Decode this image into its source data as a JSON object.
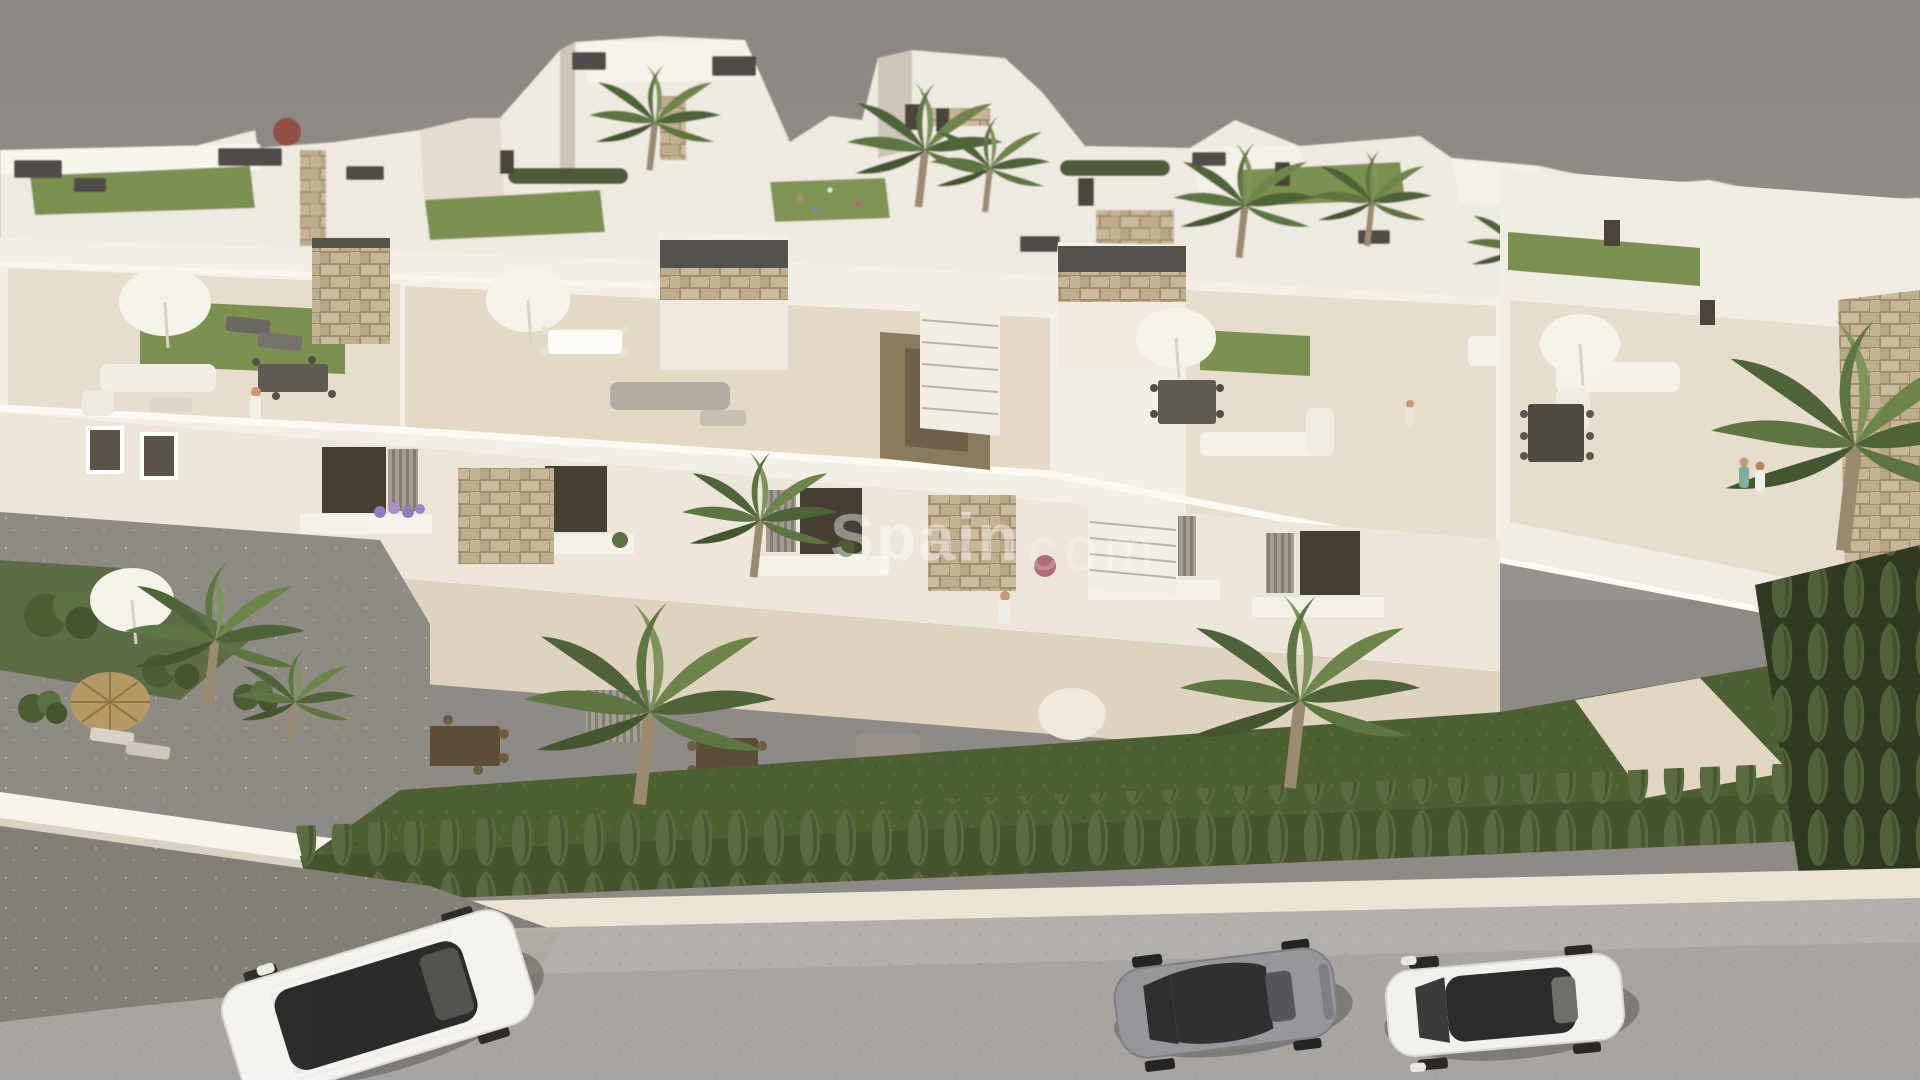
{
  "scene": {
    "type": "3d-architectural-aerial-render",
    "description": "Aerial 3D render of a modern white residential development with roof terraces, rooftop lawns, parasols, outdoor furniture, palm trees, a cypress hedge and a street with three parked cars",
    "watermark": {
      "part1": "Spain",
      "part2": "com"
    },
    "colors": {
      "sky": "#8e8a86",
      "background_buildings": "#efeae1",
      "main_building": "#f3efe7",
      "facade": "#ece6da",
      "terrace_floor": "#e6decc",
      "ground_terrace": "#ddd3be",
      "roof_lawn": "#7c9150",
      "grass": "#4d6031",
      "hedge": "#45532e",
      "curb": "#eae4d3",
      "shoulder": "#b5b1ab",
      "road": "#a8a4a0",
      "rubble": "#827e78",
      "wall": "#f6f3ec",
      "right_building": "#f1ece3",
      "stone": "#c3b294",
      "car_white": "#f3f2ee",
      "car_gray": "#96969b",
      "car_white_2": "#f1f0ec"
    },
    "cars": [
      {
        "id": "white-suv",
        "position": "bottom-left"
      },
      {
        "id": "gray-coupe",
        "position": "bottom-center"
      },
      {
        "id": "white-sedan",
        "position": "bottom-right"
      }
    ],
    "people_count": 5,
    "parasols_count": 6
  }
}
